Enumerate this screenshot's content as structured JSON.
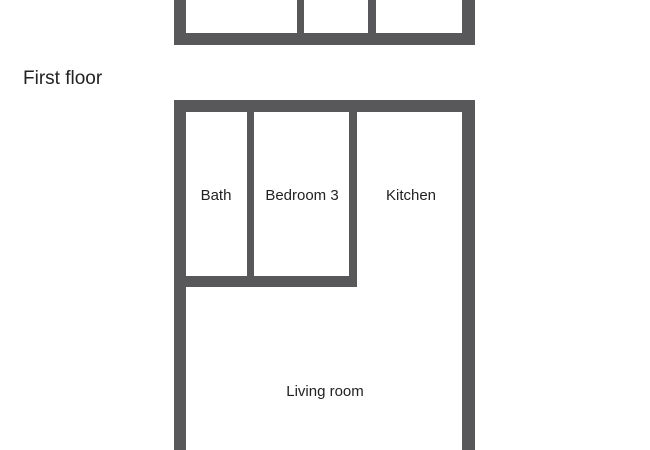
{
  "colors": {
    "wall": "#58585A",
    "text": "#222222",
    "background": "#ffffff"
  },
  "floor_label": "First floor",
  "upper_plan": {
    "description": "partial floor plan cut off at top edge, three room openings, no visible labels"
  },
  "first_floor_plan": {
    "rooms": [
      {
        "label": "Bath"
      },
      {
        "label": "Bedroom 3"
      },
      {
        "label": "Kitchen"
      },
      {
        "label": "Living room"
      }
    ]
  }
}
